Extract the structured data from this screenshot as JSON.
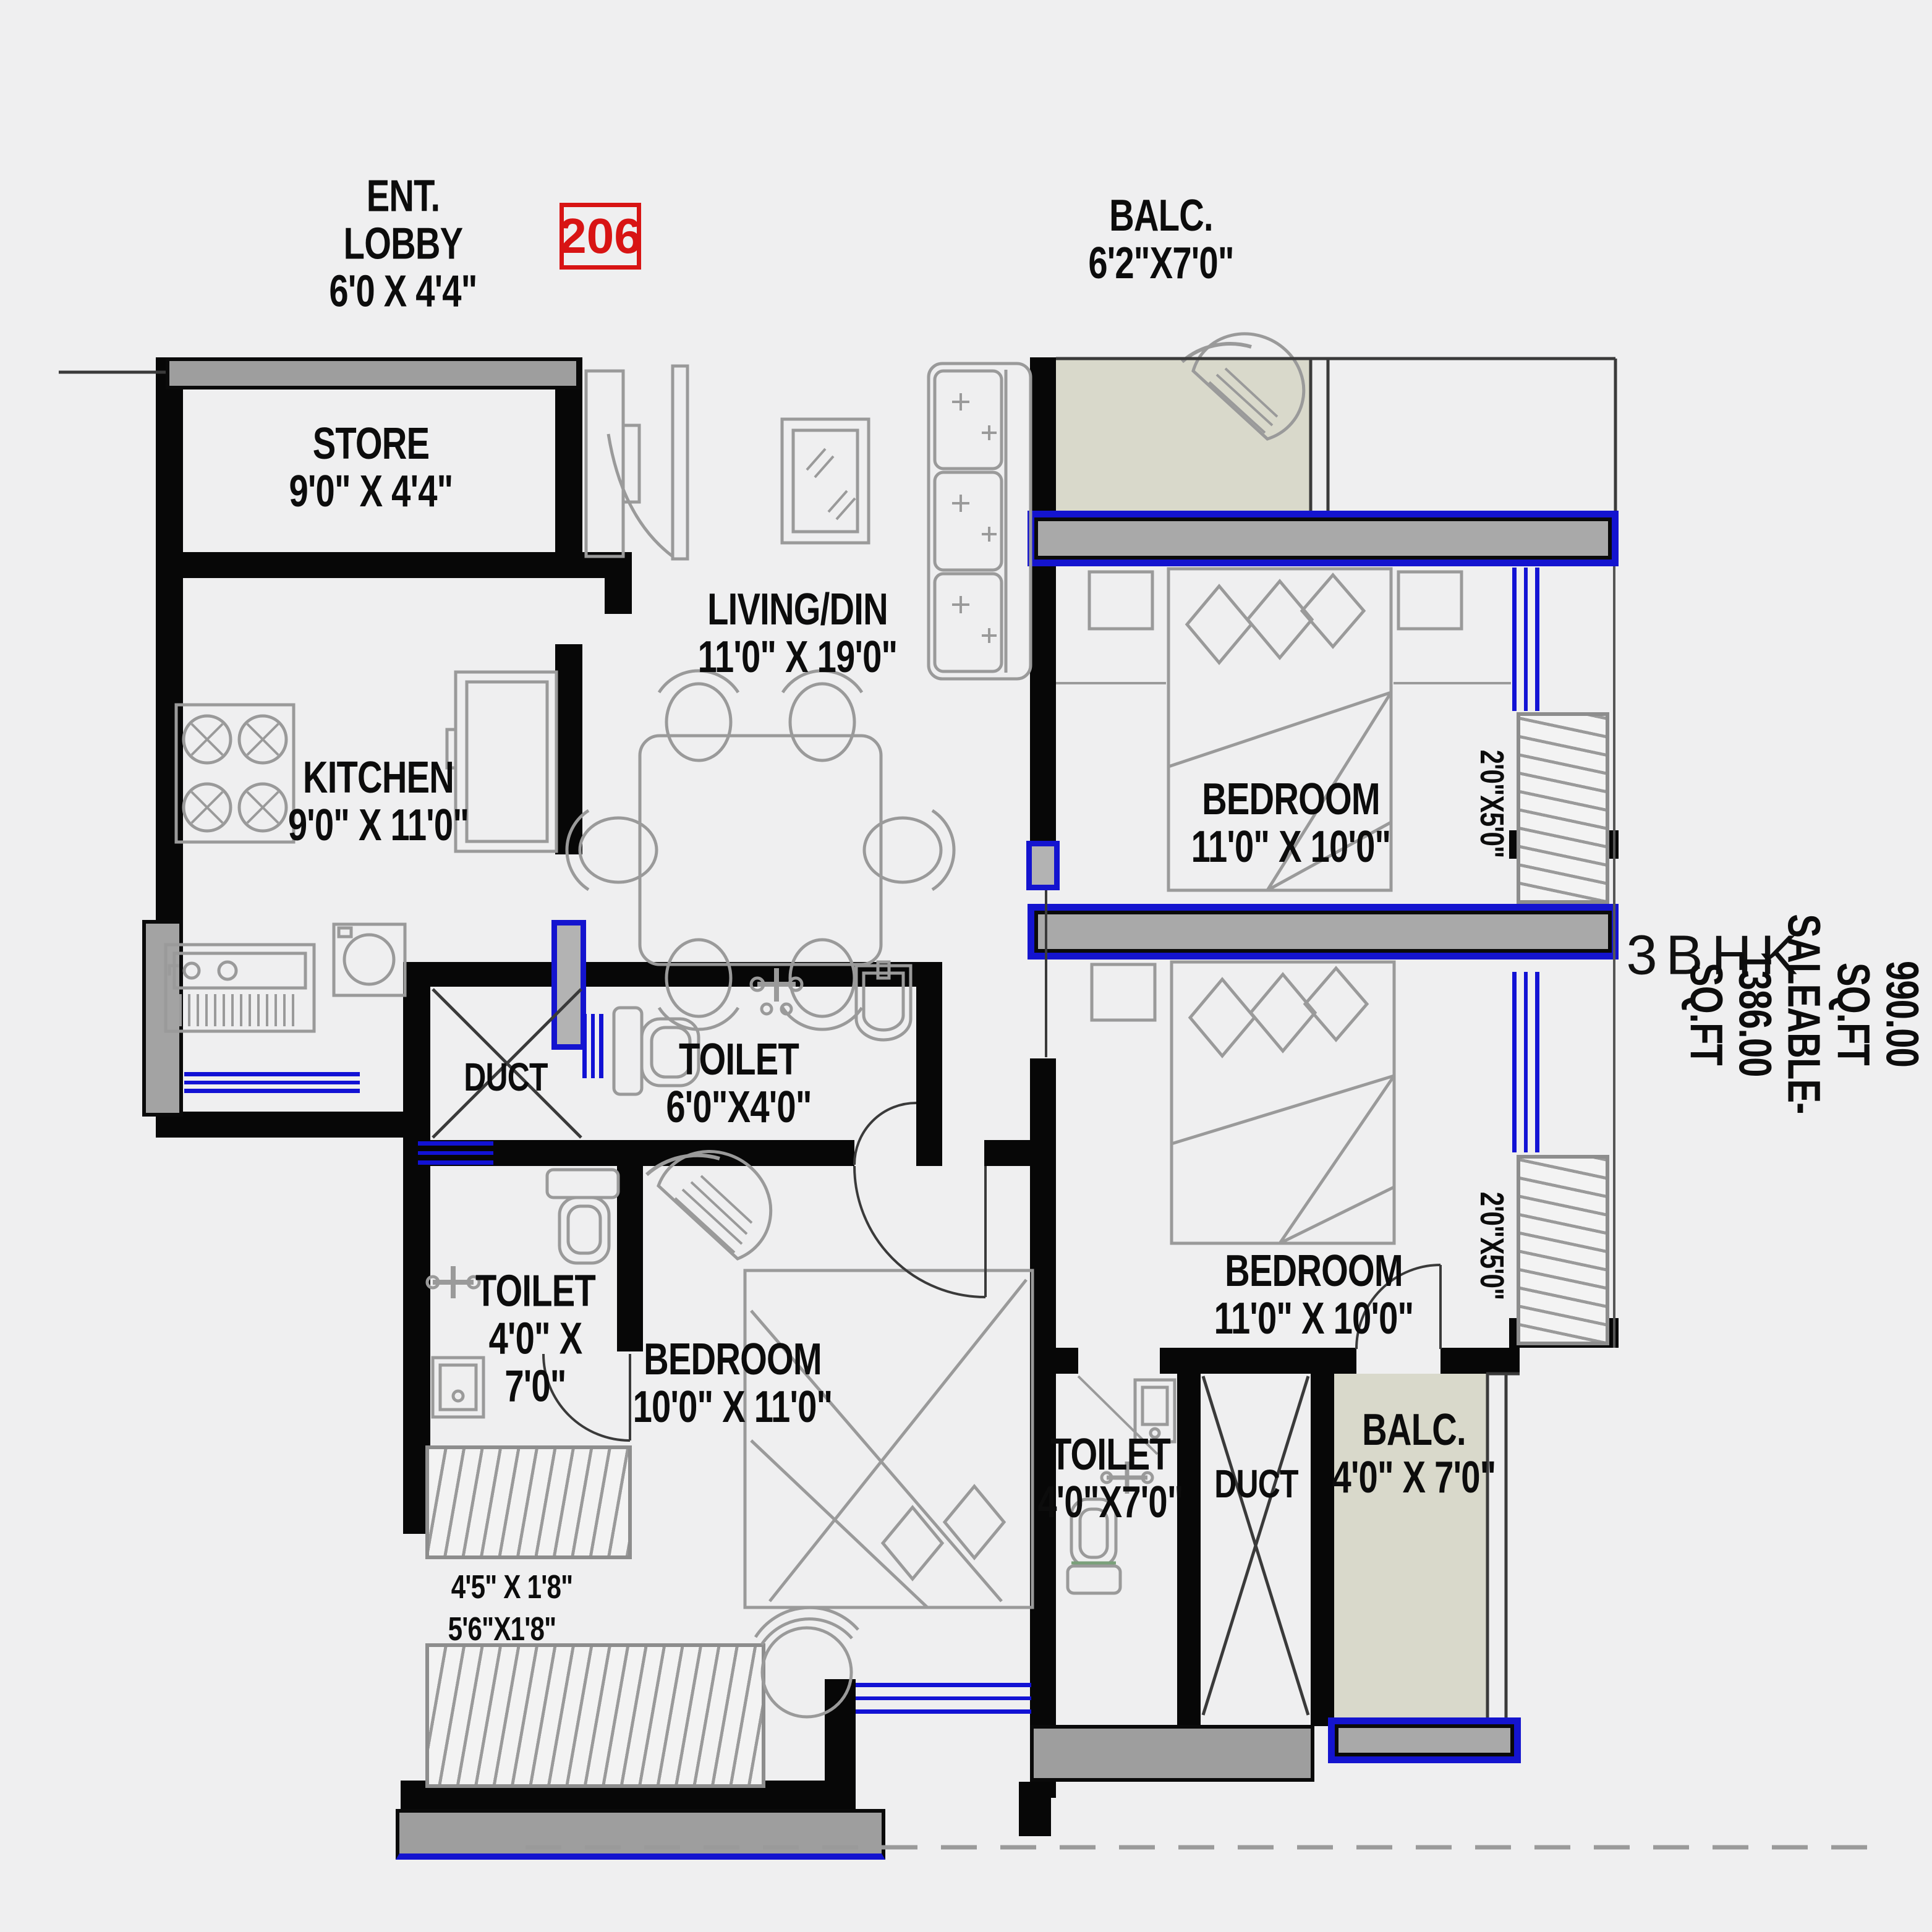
{
  "unit": {
    "number": "206",
    "type": "3BHK",
    "areas": "CARPET-990.00 SQ.FT\nSALEABLE-1386.00 SQ.FT"
  },
  "rooms": {
    "ent_lobby": "ENT.\nLOBBY\n6'0 X 4'4\"",
    "store": "STORE\n9'0\" X 4'4\"",
    "kitchen": "KITCHEN\n9'0\" X 11'0\"",
    "living": "LIVING/DIN\n11'0\" X 19'0\"",
    "balcony_top": "BALC.\n6'2\"X7'0\"",
    "bedroom_top_right": "BEDROOM\n11'0\" X 10'0\"",
    "bedroom_mid_right": "BEDROOM\n11'0\" X 10'0\"",
    "bedroom_bottom": "BEDROOM\n10'0\" X 11'0\"",
    "toilet_mid": "TOILET\n6'0\"X4'0\"",
    "toilet_left": "TOILET\n4'0\" X\n7'0\"",
    "toilet_bottom_right": "TOILET\n4'0\"X7'0\"",
    "duct_upper": "DUCT",
    "duct_lower": "DUCT",
    "balcony_bottom_right": "BALC.\n4'0\" X 7'0\""
  },
  "wardrobes": {
    "bedroom_top_right": "2'0\"X5'0\"",
    "bedroom_mid_right": "2'0\"X5'0\"",
    "bedroom_bottom_a": "4'5\" X 1'8\"",
    "bedroom_bottom_b": "5'6\"X1'8\""
  },
  "colors": {
    "wall": "#070707",
    "window": "#1212d4",
    "balcony_floor": "#d9d9cb",
    "sill": "#9e9e9e",
    "unit_number_accent": "#d81414",
    "furniture_line": "#9a9a9a"
  }
}
